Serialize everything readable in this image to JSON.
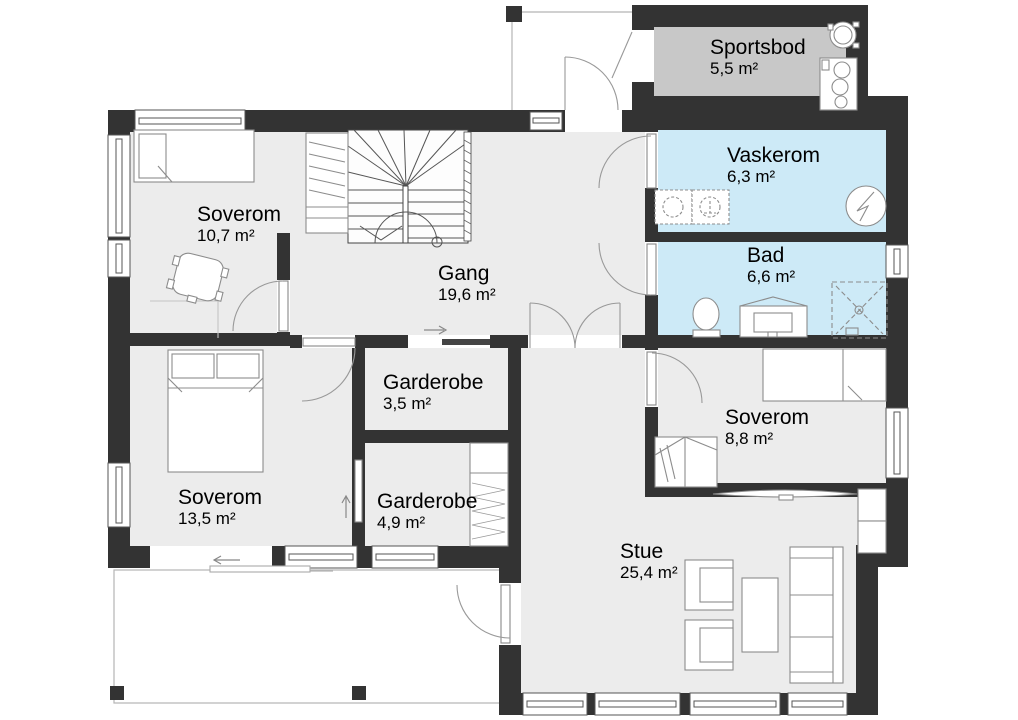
{
  "title": "Floor plan",
  "colors": {
    "wall": "#333333",
    "floor": "#ececec",
    "wet_room": "#cdeaf7",
    "storage": "#c8c8c8",
    "furniture_line": "#8c8c8c",
    "thin_line": "#aaaaaa",
    "outside": "#ffffff"
  },
  "rooms": [
    {
      "id": "sportsbod",
      "name": "Sportsbod",
      "area": "5,5 m²"
    },
    {
      "id": "vaskerom",
      "name": "Vaskerom",
      "area": "6,3 m²"
    },
    {
      "id": "bad",
      "name": "Bad",
      "area": "6,6 m²"
    },
    {
      "id": "soverom-1",
      "name": "Soverom",
      "area": "10,7 m²"
    },
    {
      "id": "gang",
      "name": "Gang",
      "area": "19,6 m²"
    },
    {
      "id": "garderobe-1",
      "name": "Garderobe",
      "area": "3,5 m²"
    },
    {
      "id": "garderobe-2",
      "name": "Garderobe",
      "area": "4,9 m²"
    },
    {
      "id": "soverom-2",
      "name": "Soverom",
      "area": "13,5 m²"
    },
    {
      "id": "soverom-3",
      "name": "Soverom",
      "area": "8,8 m²"
    },
    {
      "id": "stue",
      "name": "Stue",
      "area": "25,4 m²"
    }
  ]
}
